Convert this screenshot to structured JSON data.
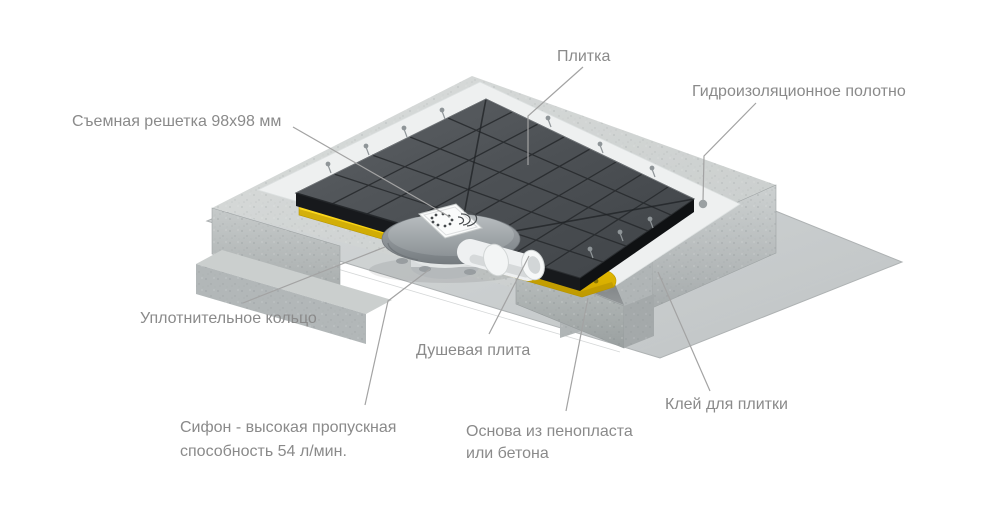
{
  "background": "#ffffff",
  "diagram_subject": "shower-drain-plate-cutaway",
  "labels": {
    "grate": "Съемная решетка 98х98 мм",
    "tile": "Плитка",
    "membrane": "Гидроизоляционное полотно",
    "sealing_ring": "Уплотнительное кольцо",
    "shower_plate": "Душевая плита",
    "siphon_line1": "Сифон - высокая пропускная",
    "siphon_line2": "способность 54 л/мин.",
    "base_line1": "Основа из пенопласта",
    "base_line2": "или бетона",
    "adhesive": "Клей для плитки"
  },
  "colors": {
    "label_text": "#8a8a8a",
    "leader_line": "#a3a3a3",
    "shower_plate_yellow": "#f5cf00",
    "tile_dark": "#4a4e52",
    "concrete_gray": "#c9cdcd",
    "membrane_white": "#eef0f0",
    "floor_sheet_gray": "#ced1d2"
  }
}
